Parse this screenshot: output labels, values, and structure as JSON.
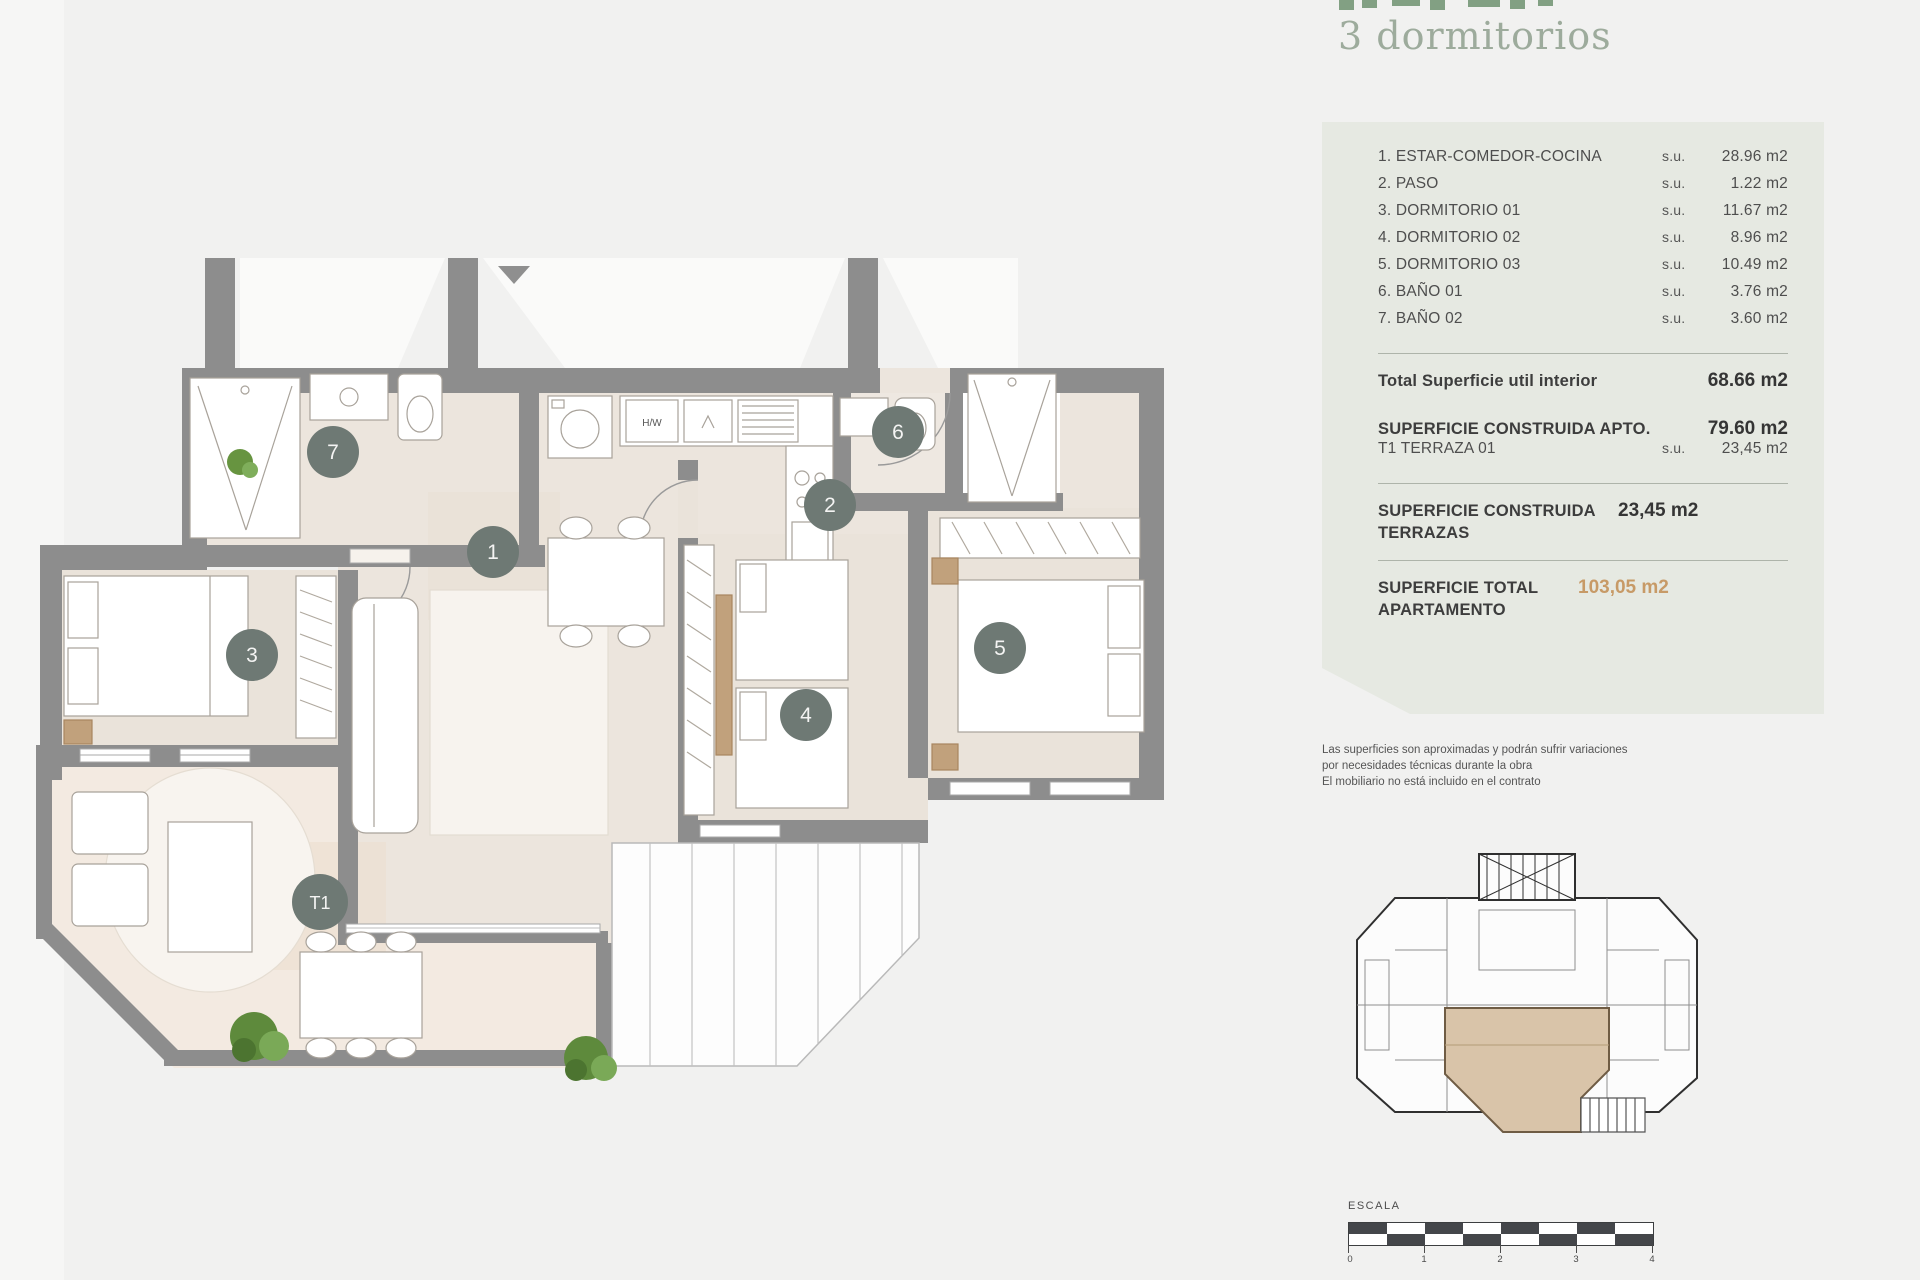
{
  "page": {
    "subtitle": "3 dormitorios"
  },
  "panel": {
    "rooms": [
      {
        "label": "1. ESTAR-COMEDOR-COCINA",
        "su": "s.u.",
        "value": "28.96 m2"
      },
      {
        "label": "2. PASO",
        "su": "s.u.",
        "value": "1.22 m2"
      },
      {
        "label": "3. DORMITORIO 01",
        "su": "s.u.",
        "value": "11.67 m2"
      },
      {
        "label": "4. DORMITORIO 02",
        "su": "s.u.",
        "value": "8.96 m2"
      },
      {
        "label": "5. DORMITORIO 03",
        "su": "s.u.",
        "value": "10.49 m2"
      },
      {
        "label": "6. BAÑO 01",
        "su": "s.u.",
        "value": "3.76 m2"
      },
      {
        "label": "7. BAÑO 02",
        "su": "s.u.",
        "value": "3.60 m2"
      }
    ],
    "total_util": {
      "label": "Total Superficie util interior",
      "value": "68.66 m2"
    },
    "construida_apto": {
      "label": "SUPERFICIE CONSTRUIDA APTO.",
      "value": "79.60 m2"
    },
    "terraza": {
      "label": "T1 TERRAZA 01",
      "su": "s.u.",
      "value": "23,45 m2"
    },
    "construida_terrazas": {
      "label": "SUPERFICIE CONSTRUIDA TERRAZAS",
      "value": "23,45 m2"
    },
    "total_apartamento": {
      "label": "SUPERFICIE TOTAL APARTAMENTO",
      "value": "103,05 m2"
    }
  },
  "disclaimer": {
    "line1": "Las superficies son aproximadas y podrán sufrir variaciones",
    "line2": "por necesidades técnicas durante la obra",
    "line3": "El mobiliario no está incluido en el contrato"
  },
  "scale": {
    "label": "ESCALA",
    "ticks": [
      "0",
      "1",
      "2",
      "3",
      "4"
    ]
  },
  "plan": {
    "kitchen_label": "H/W",
    "badges": [
      {
        "num": "1"
      },
      {
        "num": "2"
      },
      {
        "num": "3"
      },
      {
        "num": "4"
      },
      {
        "num": "5"
      },
      {
        "num": "6"
      },
      {
        "num": "7"
      },
      {
        "num": "T1"
      }
    ]
  },
  "colors": {
    "accent_orange": "#c79a67",
    "panel_sage": "#e6e9e2",
    "wall_gray": "#8d8d8d",
    "badge_gray_green": "#6e7974",
    "title_green": "#9dab9c",
    "floor_beige": "#ece5dd",
    "terrace_beige": "#f3eae1"
  }
}
